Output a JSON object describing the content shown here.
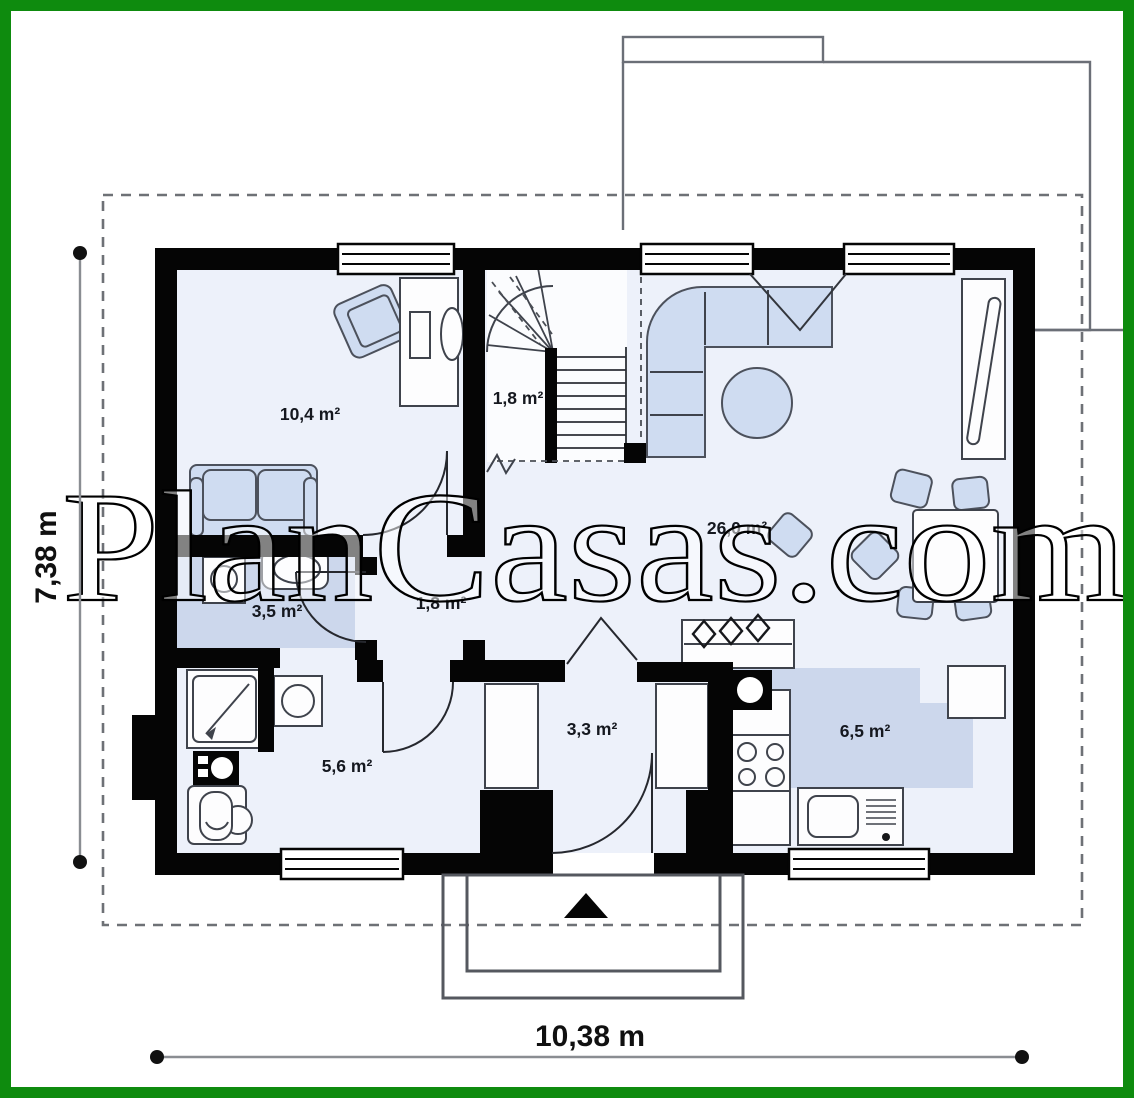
{
  "title": "Single storey house floor plan",
  "watermark": {
    "text": "PlanCasas.com"
  },
  "dimensions": {
    "width": "10,38 m",
    "height": "7,38 m"
  },
  "rooms": [
    {
      "name": "bedroom",
      "area": "10,4 m²"
    },
    {
      "name": "staircase",
      "area": "1,8 m²"
    },
    {
      "name": "living-room",
      "area": "26,0 m²"
    },
    {
      "name": "bathroom",
      "area": "3,5 m²"
    },
    {
      "name": "hall",
      "area": "1,8 m²"
    },
    {
      "name": "utility-room",
      "area": "5,6 m²"
    },
    {
      "name": "vestibule",
      "area": "3,3 m²"
    },
    {
      "name": "kitchen",
      "area": "6,5 m²"
    }
  ],
  "colors": {
    "frame_green": "#0e8b0e",
    "wall_black": "#050505",
    "room_fill": "#edf1fa",
    "shaded_fill": "#ccd7ec",
    "furniture_fill": "#cfdcf1"
  }
}
